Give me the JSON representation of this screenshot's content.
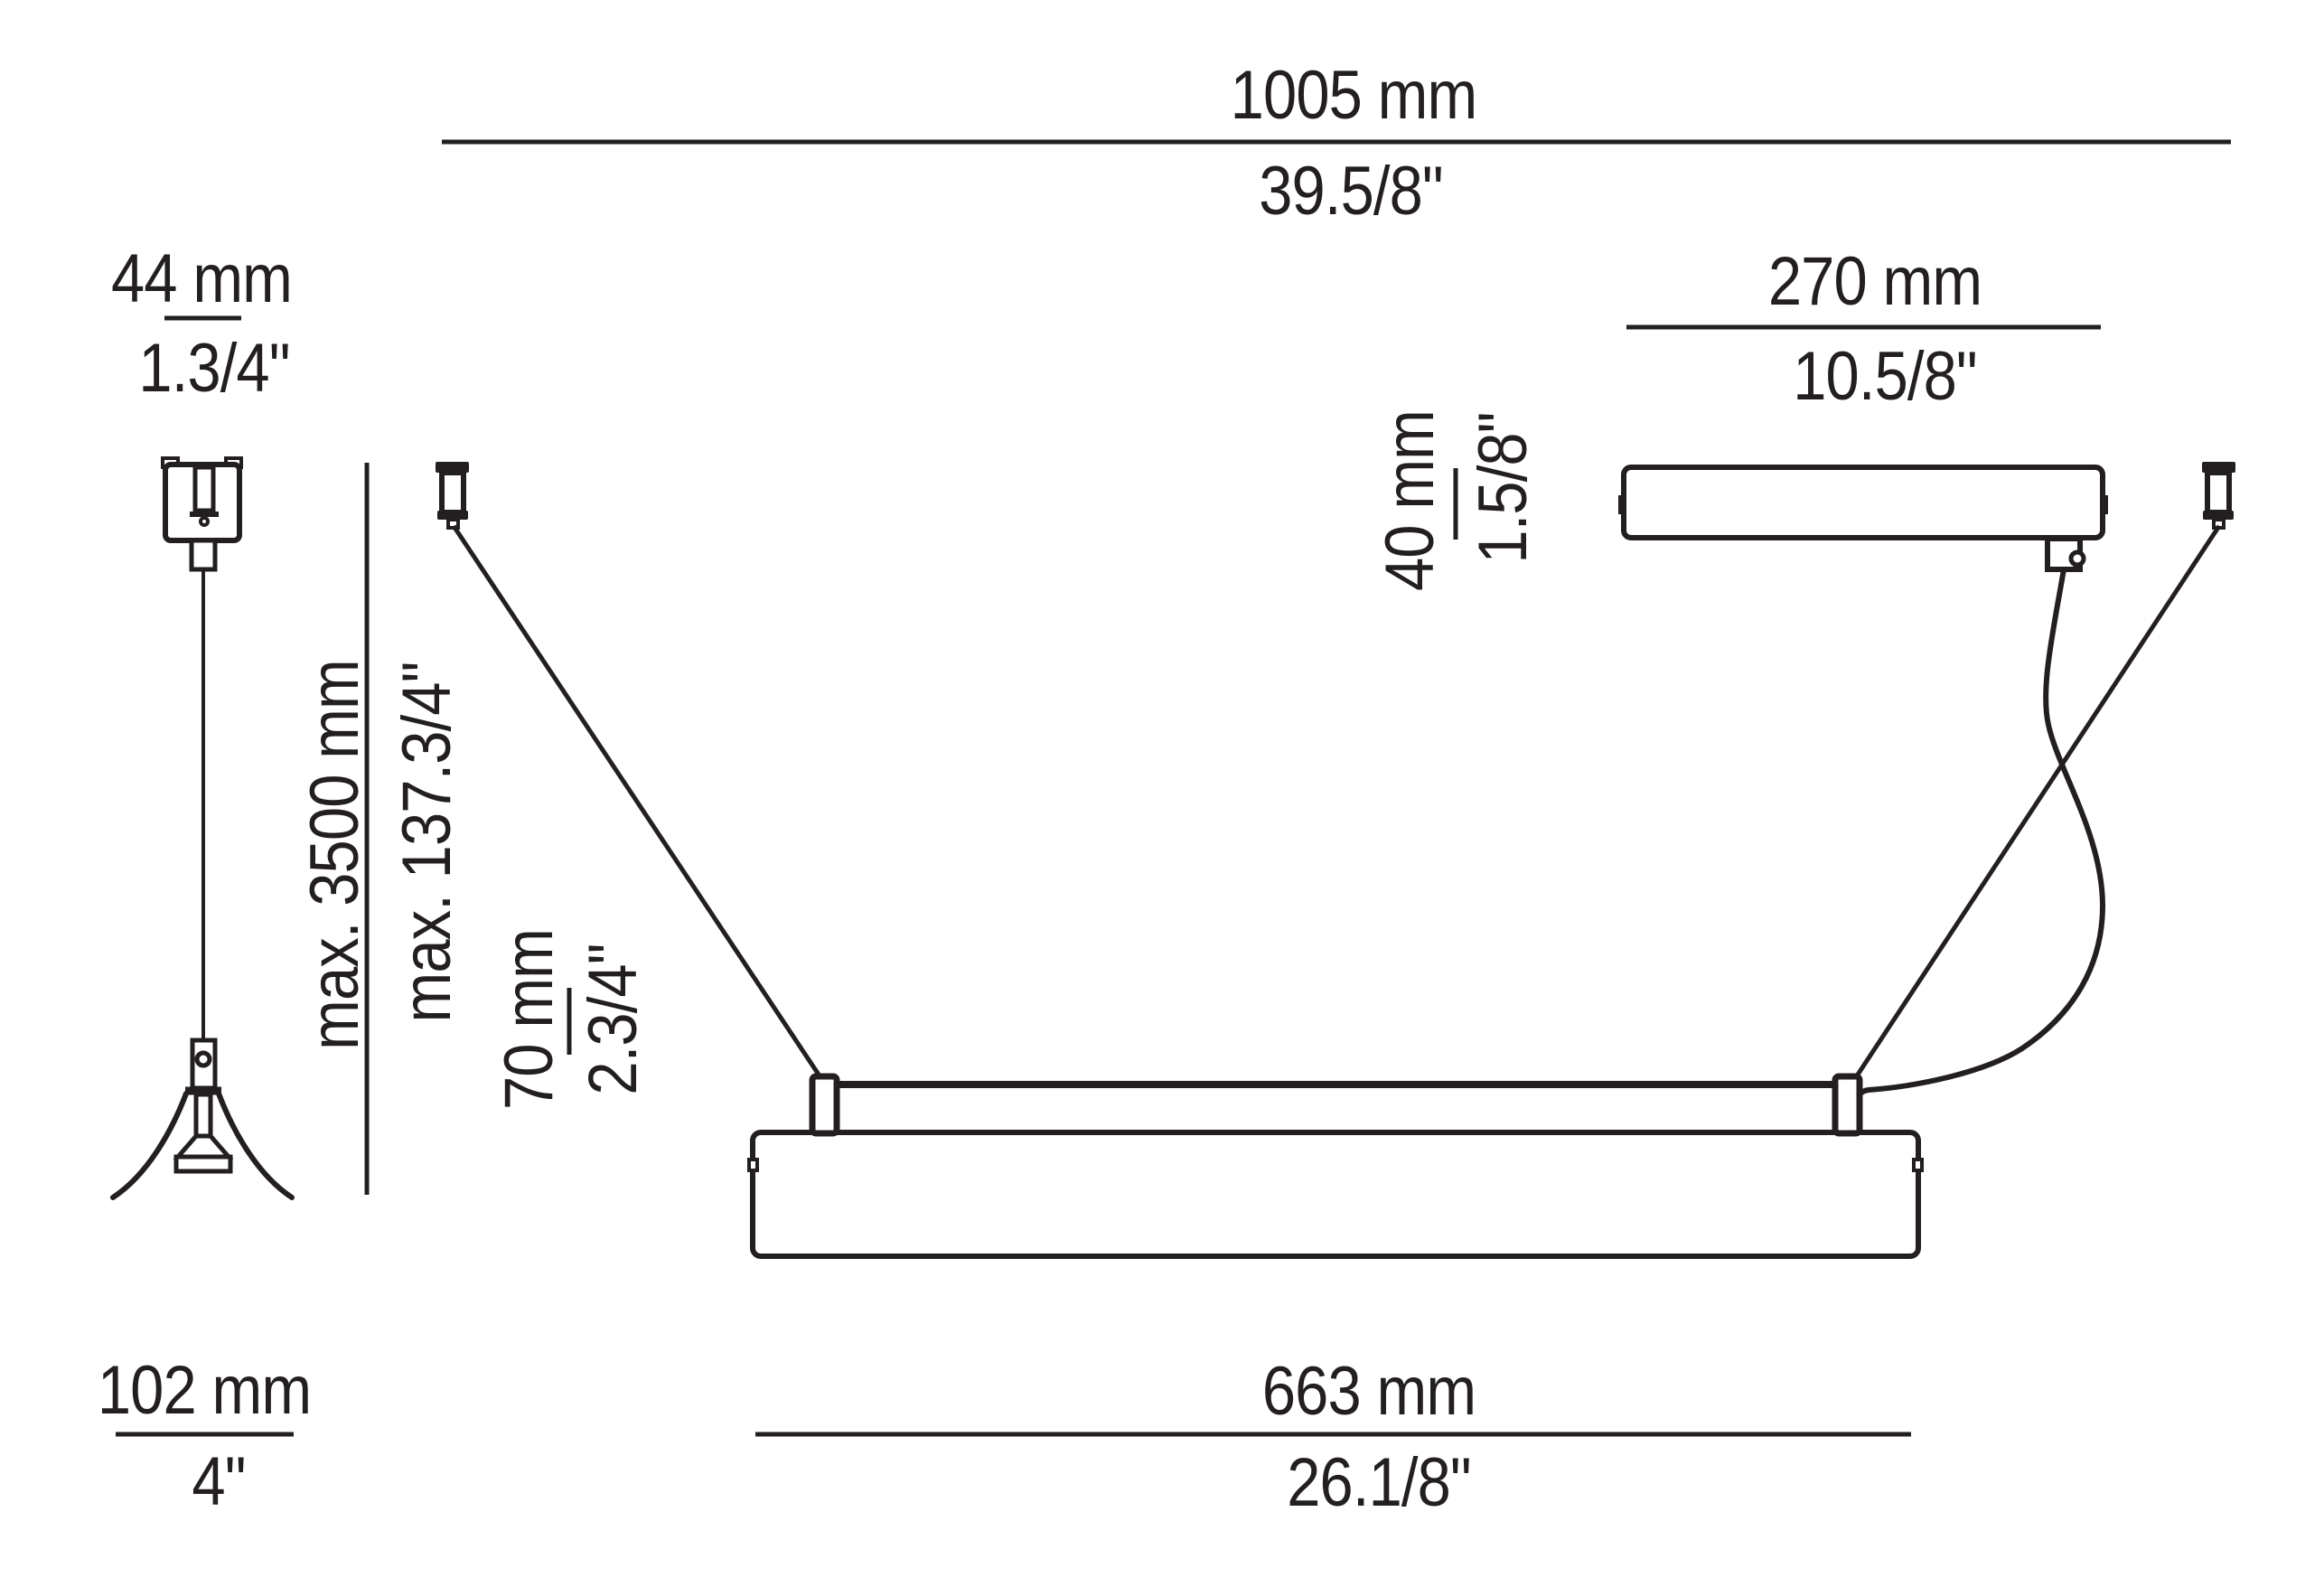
{
  "colors": {
    "ink": "#231f20",
    "background": "#ffffff"
  },
  "dims": {
    "overall_width": {
      "mm": "1005 mm",
      "inch": "39.5/8\""
    },
    "gripper_detail_width": {
      "mm": "44 mm",
      "inch": "1.3/4\""
    },
    "canopy_width": {
      "mm": "270 mm",
      "inch": "10.5/8\""
    },
    "canopy_height": {
      "mm": "40 mm",
      "inch": "1.5/8\""
    },
    "suspension_length": {
      "mm": "max. 3500 mm",
      "inch": "max. 137.3/4\""
    },
    "body_height": {
      "mm": "70 mm",
      "inch": "2.3/4\""
    },
    "gripper_shade_width": {
      "mm": "102 mm",
      "inch": "4\""
    },
    "body_width": {
      "mm": "663 mm",
      "inch": "26.1/8\""
    }
  }
}
